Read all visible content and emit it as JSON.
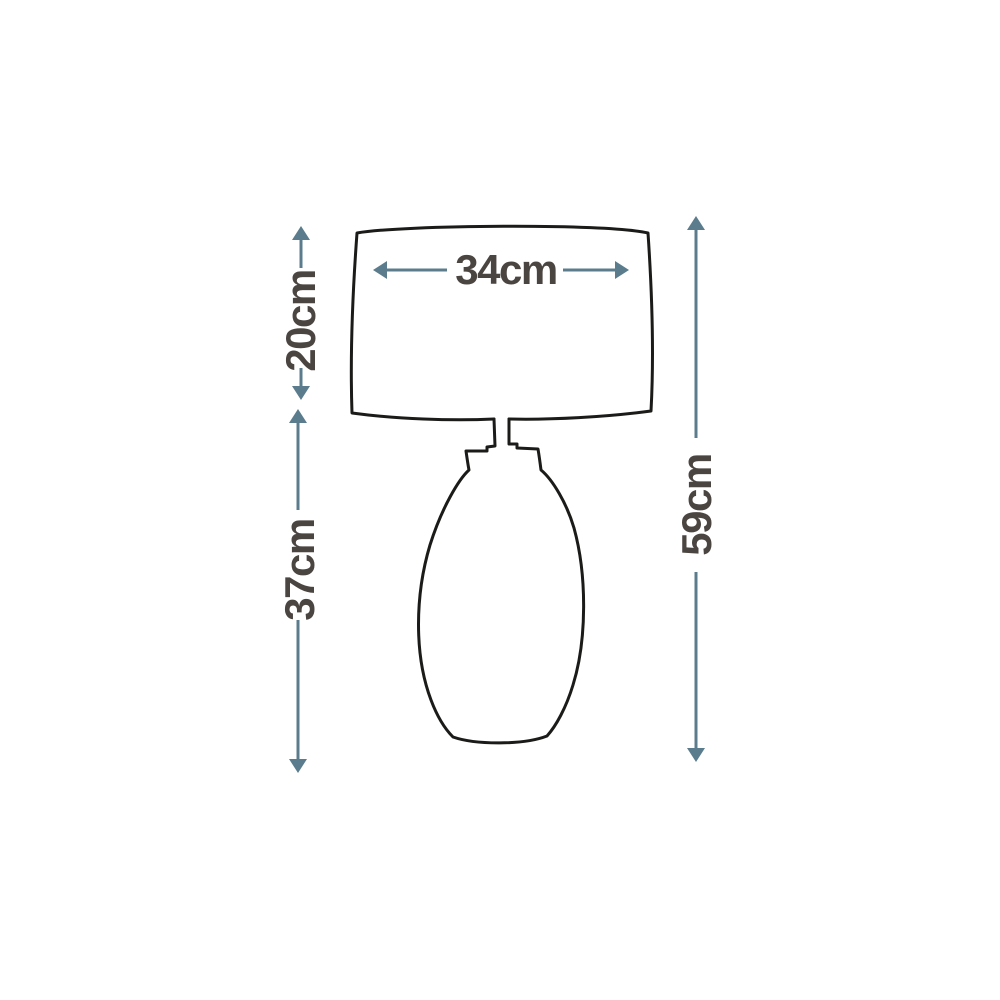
{
  "diagram": {
    "type": "product-dimension-line-drawing",
    "subject": "table lamp with drum shade and oval base",
    "colors": {
      "background": "#ffffff",
      "outline": "#1b1b19",
      "dimension_lines": "#5b7c8d",
      "labels": "#4b4541"
    },
    "dimensions": {
      "shade_width": {
        "label": "34cm"
      },
      "shade_height": {
        "label": "20cm"
      },
      "base_height": {
        "label": "37cm"
      },
      "total_height": {
        "label": "59cm"
      }
    }
  }
}
